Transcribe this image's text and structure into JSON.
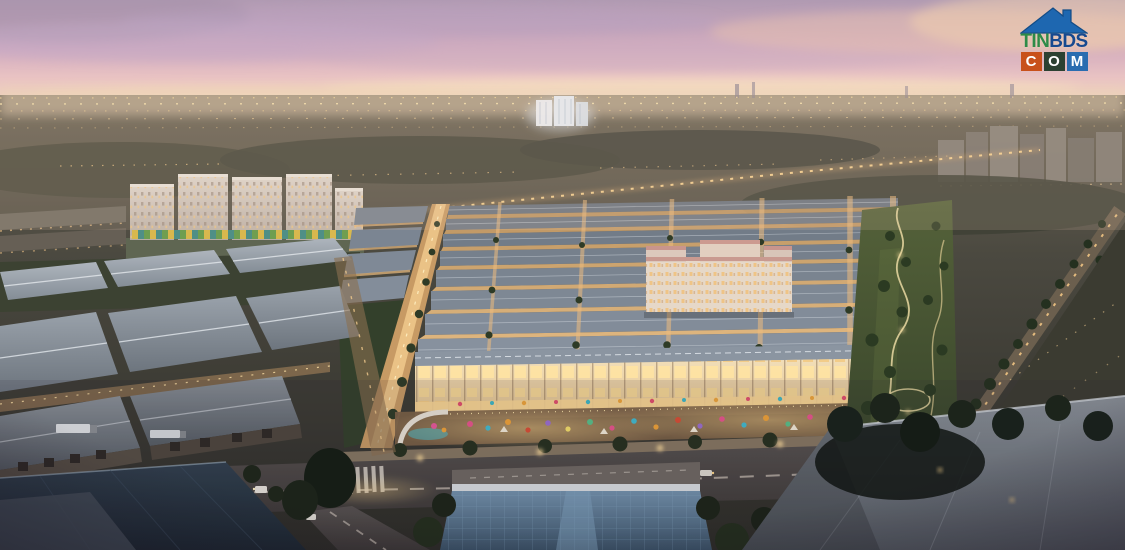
{
  "watermark": {
    "site_name": "TINBDS.COM",
    "tin": "TIN",
    "bds": "BDS",
    "com_letters": [
      "C",
      "O",
      "M"
    ],
    "colors": {
      "house_roof": "#1e67b0",
      "tin_text": "#2e8b47",
      "bds_text": "#17498f",
      "tile_c_bg": "#c8511b",
      "tile_o_bg": "#2c4132",
      "tile_m_bg": "#2a6cb0",
      "tile_text": "#ffffff"
    }
  },
  "scene": {
    "setting": "dusk aerial 3D render of a mixed-use real estate development",
    "elements": [
      "pink sunset sky",
      "distant city skyline with lights",
      "cream apartment towers with colorful podium",
      "grid of townhouse rows with lit streets",
      "cream hotel block",
      "illuminated shophouse row",
      "colorful market street",
      "main boulevard with cars and crosswalk",
      "industrial warehouses with gray roofs",
      "blue glass-roof hall",
      "linear park with winding lit paths",
      "tree-lined diagonal avenue"
    ],
    "palette": {
      "sky_top": "#b09ab2",
      "sky_pink": "#e9c3c3",
      "horizon": "#f3debd",
      "street_glow": "#f2c684",
      "townhouse_roof": "#6e7886",
      "warehouse_roof": "#9aa2ab",
      "park_green": "#44522f",
      "road_asphalt": "#4a4542",
      "glass_roof": "#4c6confirm"
    }
  }
}
